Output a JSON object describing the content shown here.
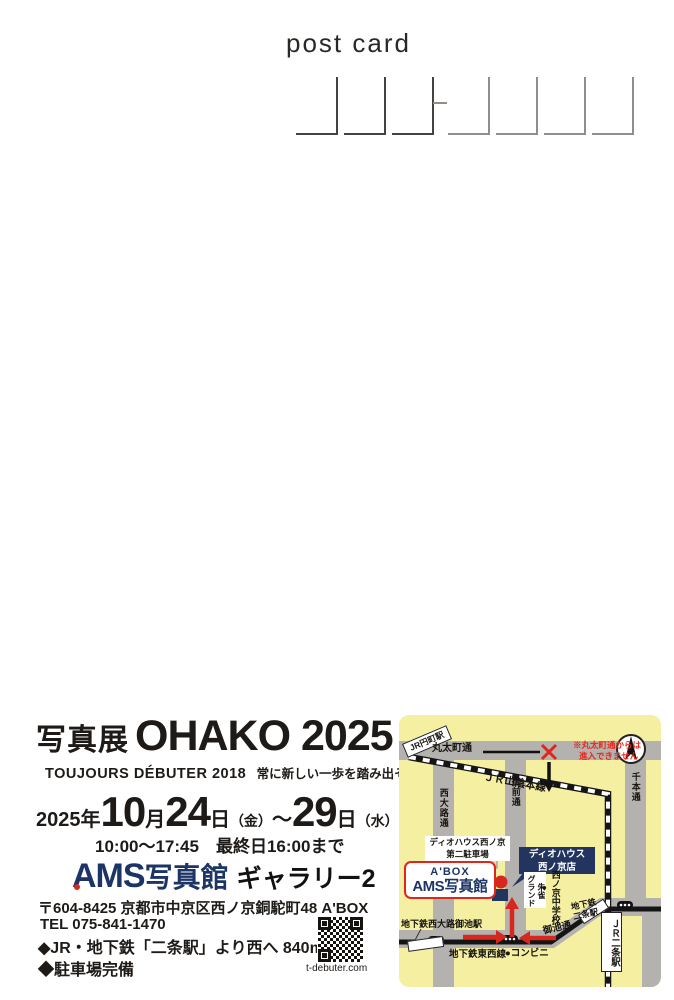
{
  "header": {
    "post_card": "post card"
  },
  "exhibition": {
    "prefix": "写真展",
    "title": "OHAKO 2025",
    "subtitle_en": "TOUJOURS DÉBUTER 2018",
    "subtitle_ja": "常に新しい一歩を踏み出そう",
    "year": "2025年",
    "month": "10",
    "month_label": "月",
    "day_start": "24",
    "day_label1": "日",
    "dow_start": "（金）",
    "range": "〜",
    "day_end": "29",
    "day_label2": "日",
    "dow_end": "（水）",
    "hours": "10:00〜17:45　最終日16:00まで"
  },
  "venue": {
    "logo": "AMS",
    "logo_suffix": "写真館",
    "gallery": "ギャラリー2",
    "postal_address": "〒604-8425 京都市中京区西ノ京銅駝町48 A'BOX",
    "tel": "TEL 075-841-1470",
    "access": "◆JR・地下鉄「二条駅」より西へ 840m",
    "parking": "◆駐車場完備",
    "site": "t-debuter.com"
  },
  "map": {
    "roads": {
      "marutamachi": "丸太町通",
      "nishioji": "西大路通",
      "onmae": "御前通",
      "senbon": "千本通",
      "oike": "御池通"
    },
    "lines": {
      "sanin": "ＪＲ山陰本線",
      "tozai": "地下鉄東西線"
    },
    "stations": {
      "enmachi": "JR円町駅",
      "nishioji_oike": "地下鉄西大路御池駅",
      "nijo_subway_1": "地下鉄",
      "nijo_subway_2": "二条駅",
      "jr_nijo": "ＪＲ二条駅"
    },
    "places": {
      "parking_1": "ディオハウス西ノ京",
      "parking_2": "第二駐車場",
      "dio_1": "ディオハウス",
      "dio_2": "西ノ京店",
      "suzaku_1": "朱雀",
      "suzaku_2": "グランド",
      "school_dot": "●",
      "school": "西ノ京中学校",
      "conbini": "●コンビニ",
      "abox": "A'BOX",
      "ams": "AMS写真館"
    },
    "warning_1": "※丸太町通からは",
    "warning_2": "進入できません",
    "colors": {
      "bg": "#f4efa1",
      "road": "#b4b2af",
      "navy": "#23355e",
      "red": "#d7281e",
      "logo_navy": "#1c3566"
    }
  }
}
